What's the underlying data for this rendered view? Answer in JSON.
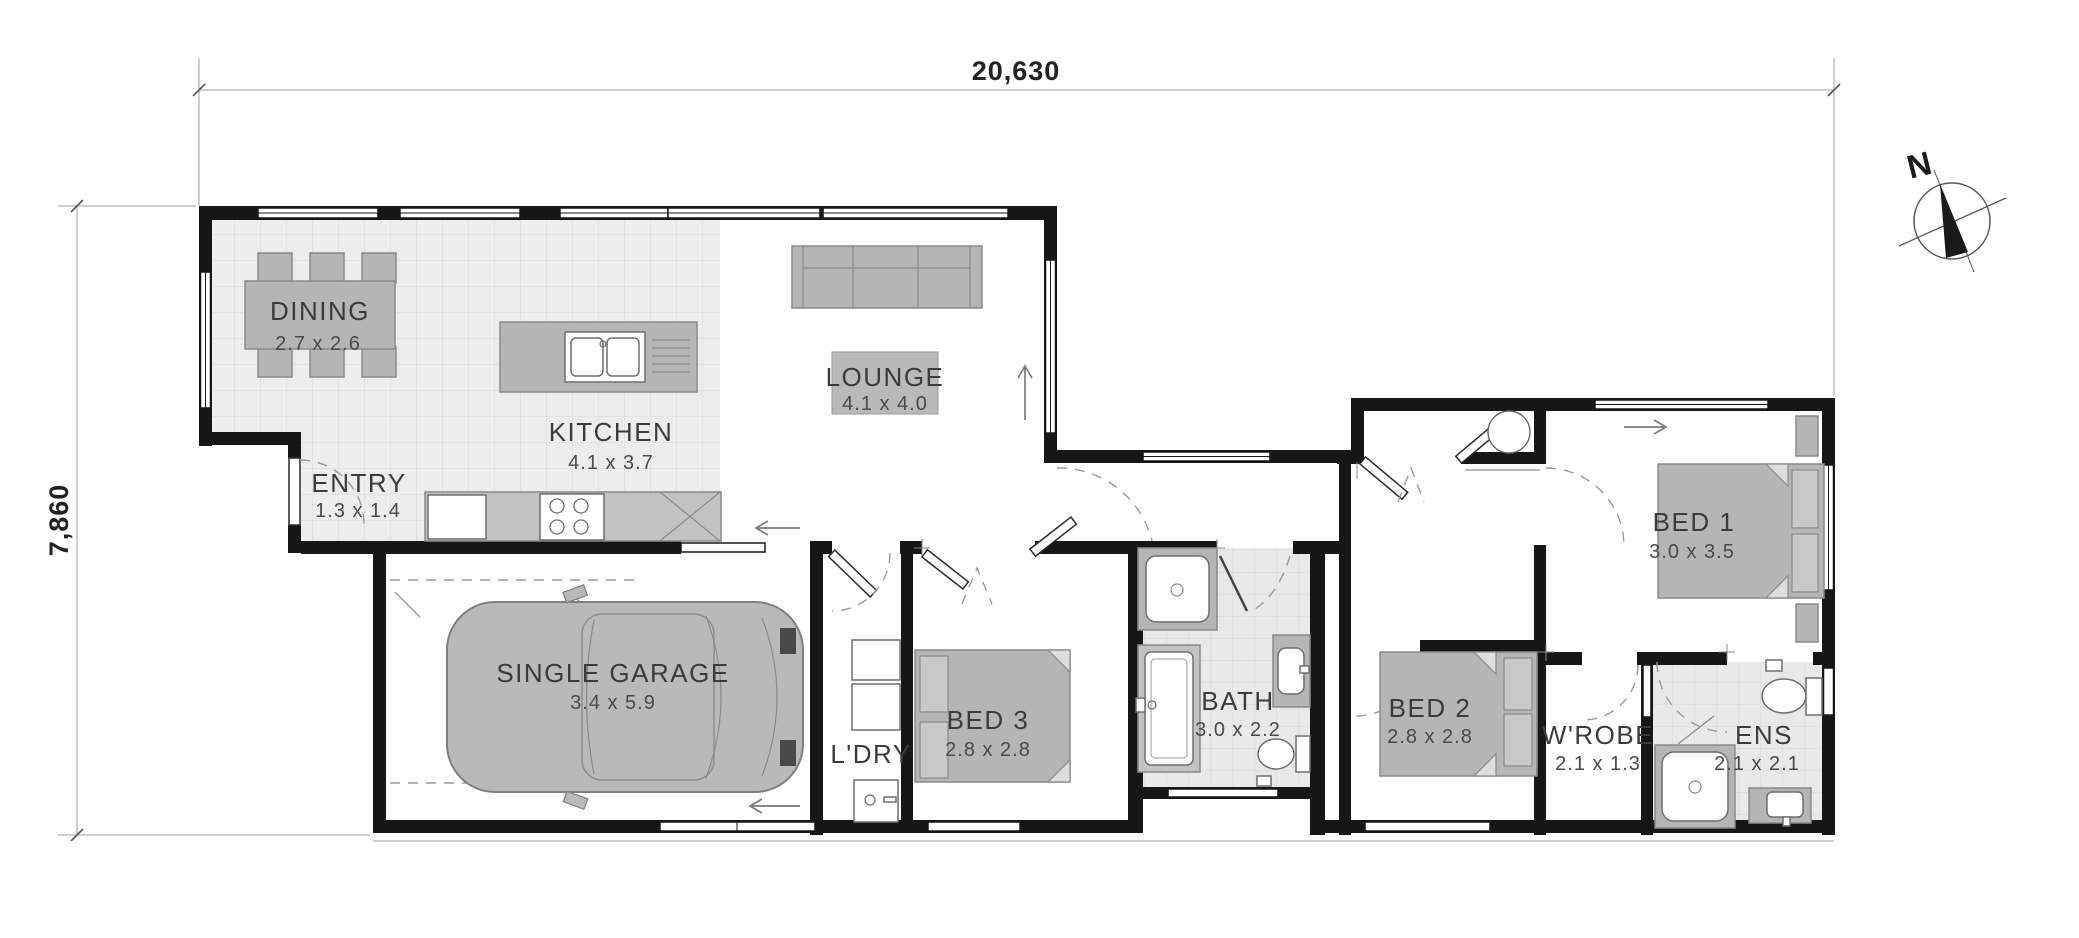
{
  "dimensions": {
    "width_label": "20,630",
    "height_label": "7,860"
  },
  "compass": {
    "north_label": "N"
  },
  "rooms": [
    {
      "id": "dining",
      "name": "DINING",
      "size": "2.7 x 2.6"
    },
    {
      "id": "kitchen",
      "name": "KITCHEN",
      "size": "4.1 x 3.7"
    },
    {
      "id": "entry",
      "name": "ENTRY",
      "size": "1.3 x 1.4"
    },
    {
      "id": "lounge",
      "name": "LOUNGE",
      "size": "4.1 x 4.0"
    },
    {
      "id": "garage",
      "name": "SINGLE GARAGE",
      "size": "3.4 x 5.9"
    },
    {
      "id": "laundry",
      "name": "L'DRY",
      "size": ""
    },
    {
      "id": "bed3",
      "name": "BED 3",
      "size": "2.8 x 2.8"
    },
    {
      "id": "bath",
      "name": "BATH",
      "size": "3.0 x 2.2"
    },
    {
      "id": "bed2",
      "name": "BED 2",
      "size": "2.8 x 2.8"
    },
    {
      "id": "wrobe",
      "name": "W'ROBE",
      "size": "2.1 x 1.3"
    },
    {
      "id": "bed1",
      "name": "BED 1",
      "size": "3.0 x 3.5"
    },
    {
      "id": "ens",
      "name": "ENS",
      "size": "2.1 x 2.1"
    }
  ],
  "colors": {
    "wall": "#161616",
    "furniture_fill": "#b5b5b5",
    "furniture_stroke": "#8a8a8a",
    "tile_fill": "#ededed",
    "tile_line": "#d8d8d8",
    "dashed_line": "#9a9a9a",
    "label_text": "#3b3b3b"
  }
}
